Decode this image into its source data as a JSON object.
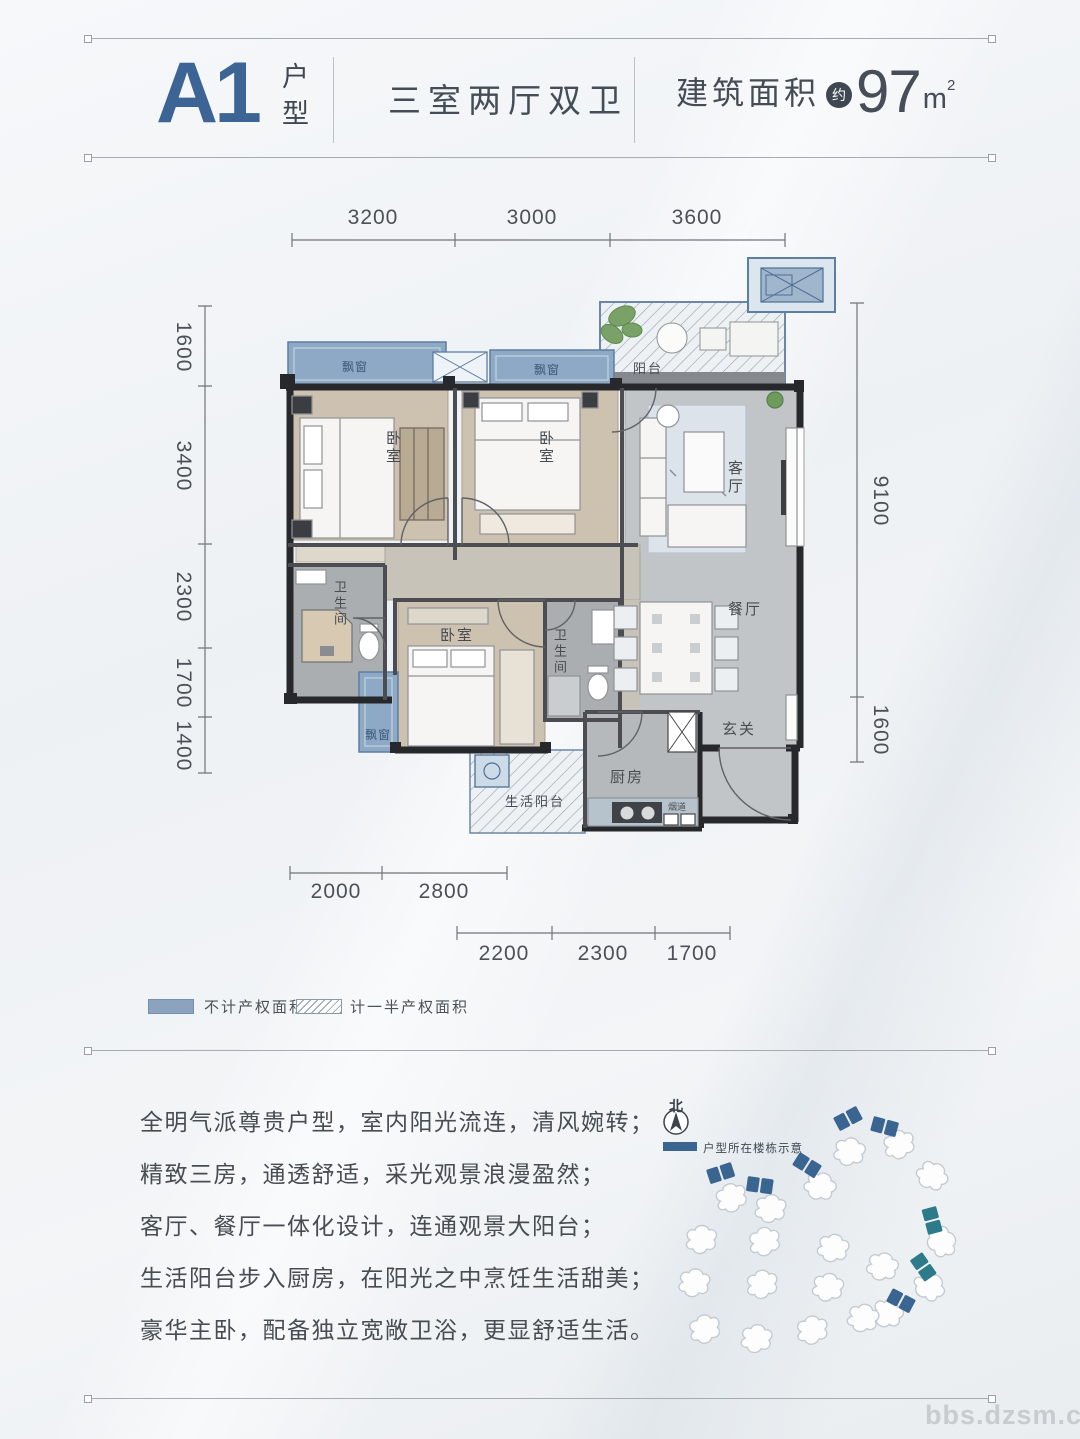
{
  "header": {
    "unit": "A1",
    "unit_suffix": "户型",
    "subtitle": "三室两厅双卫",
    "area_label": "建筑面积",
    "area_approx": "约",
    "area_value": "97",
    "area_unit": "m",
    "area_sup": "2",
    "accent_color": "#3c6494"
  },
  "plan": {
    "dims_top": [
      "3200",
      "3000",
      "3600"
    ],
    "dims_left": [
      "1600",
      "3400",
      "2300",
      "1700",
      "1400"
    ],
    "dims_right": [
      "9100",
      "1600"
    ],
    "dims_bottom_row1": [
      "2000",
      "2800"
    ],
    "dims_bottom_row2": [
      "2200",
      "2300",
      "1700"
    ],
    "rooms": {
      "bay_window": "飘窗",
      "balcony": "阳台",
      "bedroom": "卧室",
      "living": "客厅",
      "dining": "餐厅",
      "foyer": "玄关",
      "bath": "卫生间",
      "kitchen": "厨房",
      "service_balcony": "生活阳台",
      "flue": "烟道"
    },
    "colors": {
      "bay_blue": "#8ea9c6",
      "wall_dark": "#27282c",
      "wood_floor": "#cdc1af",
      "gray_floor": "#c2c5c7"
    }
  },
  "legend": {
    "no_rights": "不计产权面积",
    "half_rights": "计一半产权面积"
  },
  "description": {
    "lines": [
      "全明气派尊贵户型，室内阳光流连，清风婉转；",
      "精致三房，通透舒适，采光观景浪漫盈然；",
      "客厅、餐厅一体化设计，连通观景大阳台；",
      "生活阳台步入厨房，在阳光之中烹饪生活甜美；",
      "豪华主卧，配备独立宽敞卫浴，更显舒适生活。"
    ]
  },
  "siteplan": {
    "north": "北",
    "legend": "户型所在楼栋示意",
    "highlight_color": "#3a6590",
    "highlight_color2": "#2c7a8a"
  },
  "watermark": "bbs.dzsm.com"
}
